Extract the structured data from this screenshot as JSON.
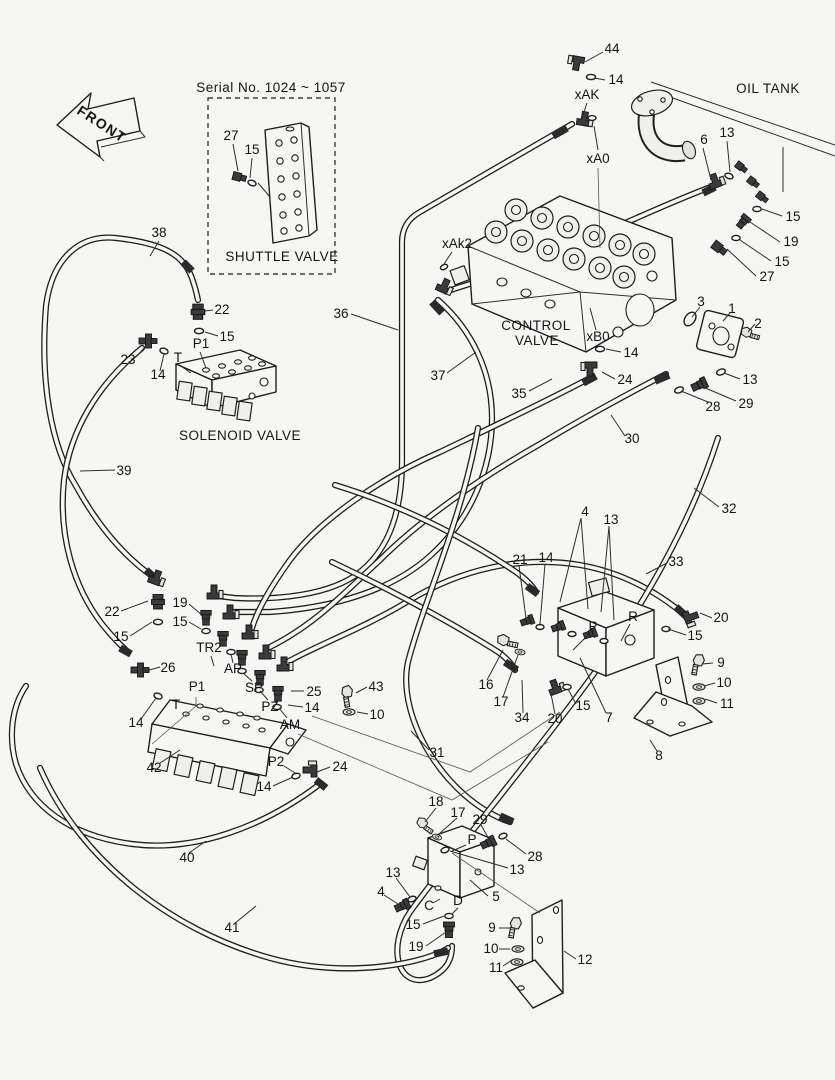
{
  "titles": {
    "front_arrow": "FRONT",
    "serial_note": "Serial No. 1024 ~ 1057",
    "shuttle_valve": "SHUTTLE VALVE",
    "oil_tank": "OIL TANK",
    "control_valve_1": "CONTROL",
    "control_valve_2": "VALVE",
    "solenoid_valve": "SOLENOID VALVE"
  },
  "ports": {
    "xak": "xAK",
    "xa0": "xA0",
    "xak2": "xAk2",
    "xb0": "xB0",
    "p1_top": "P1",
    "t_top": "T",
    "tr2": "TR2",
    "ap": "AP",
    "sp": "SP",
    "pz": "PZ",
    "am": "AM",
    "p1_mid": "P1",
    "t_mid": "T",
    "p2": "P2",
    "p_valve7": "P",
    "r_valve7": "R",
    "p_valve5": "P",
    "c_port": "C",
    "d_port": "D"
  },
  "colors": {
    "background": "#f6f6f4",
    "ink": "#1e1e1e"
  },
  "callouts": [
    {
      "part": "44"
    },
    {
      "part": "14"
    },
    {
      "part": "6"
    },
    {
      "part": "13"
    },
    {
      "part": "15"
    },
    {
      "part": "19"
    },
    {
      "part": "15"
    },
    {
      "part": "27"
    },
    {
      "part": "27"
    },
    {
      "part": "15"
    },
    {
      "part": "38"
    },
    {
      "part": "22"
    },
    {
      "part": "15"
    },
    {
      "part": "23"
    },
    {
      "part": "14"
    },
    {
      "part": "36"
    },
    {
      "part": "37"
    },
    {
      "part": "35"
    },
    {
      "part": "3"
    },
    {
      "part": "1"
    },
    {
      "part": "2"
    },
    {
      "part": "13"
    },
    {
      "part": "29"
    },
    {
      "part": "28"
    },
    {
      "part": "14"
    },
    {
      "part": "24"
    },
    {
      "part": "30"
    },
    {
      "part": "32"
    },
    {
      "part": "39"
    },
    {
      "part": "22"
    },
    {
      "part": "15"
    },
    {
      "part": "19"
    },
    {
      "part": "15"
    },
    {
      "part": "26"
    },
    {
      "part": "14"
    },
    {
      "part": "25"
    },
    {
      "part": "14"
    },
    {
      "part": "43"
    },
    {
      "part": "10"
    },
    {
      "part": "42"
    },
    {
      "part": "24"
    },
    {
      "part": "14"
    },
    {
      "part": "31"
    },
    {
      "part": "40"
    },
    {
      "part": "41"
    },
    {
      "part": "4"
    },
    {
      "part": "13"
    },
    {
      "part": "21"
    },
    {
      "part": "14"
    },
    {
      "part": "33"
    },
    {
      "part": "20"
    },
    {
      "part": "15"
    },
    {
      "part": "16"
    },
    {
      "part": "17"
    },
    {
      "part": "34"
    },
    {
      "part": "20"
    },
    {
      "part": "15"
    },
    {
      "part": "7"
    },
    {
      "part": "9"
    },
    {
      "part": "10"
    },
    {
      "part": "11"
    },
    {
      "part": "8"
    },
    {
      "part": "18"
    },
    {
      "part": "17"
    },
    {
      "part": "29"
    },
    {
      "part": "28"
    },
    {
      "part": "13"
    },
    {
      "part": "13"
    },
    {
      "part": "4"
    },
    {
      "part": "5"
    },
    {
      "part": "15"
    },
    {
      "part": "19"
    },
    {
      "part": "9"
    },
    {
      "part": "10"
    },
    {
      "part": "11"
    },
    {
      "part": "12"
    }
  ]
}
